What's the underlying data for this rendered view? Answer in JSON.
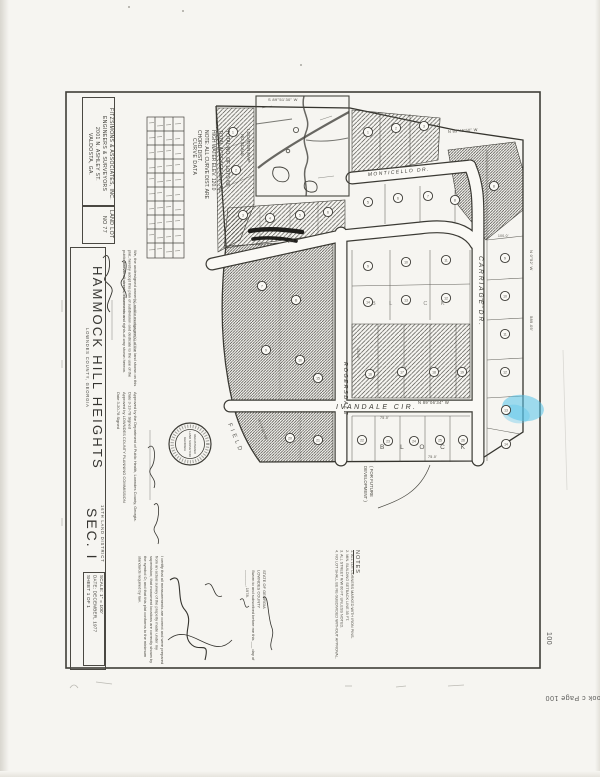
{
  "page": {
    "stamp_bottom": "look c Page 100",
    "stamp_side": "100",
    "highlight_color": "#53c3ea"
  },
  "title_block": {
    "firm_lines": [
      "FITZSIMONS & ASSOCIATES, INC.",
      "ENGINEERS & SURVEYORS",
      "2001 N. ASHLEY ST.",
      "VALDOSTA, GA."
    ],
    "land_lot": "LAND LOT NO 77",
    "title": "HAMMOCK HILL HEIGHTS",
    "county": "LOWNDES COUNTY, GEORGIA",
    "district": "16TH LAND DISTRICT",
    "section": "SEC. I",
    "scale": "SCALE: 1\" = 100'",
    "date": "DATE: DECEMBER, 1977",
    "sheet": "SHEET 1 OF 1"
  },
  "approvals": {
    "owner_cert": "We, the undersigned owner(s) and/or mortgagee(s) of the land shown on this plat, hereby adopt this plan of subdivision and dedicate to the use of the public forever all streets, easements and rights-of-way shown hereon.",
    "health": "Approved by the Department of Public Health, Lowndes County, Georgia.",
    "health_date": "Date  3-13-78      Signed",
    "planning": "Approved by  LOWNDES COUNTY  PLANNING COMMISSION",
    "planning_date": "Date  3-20-78      Signed",
    "surveyor_cert": "I certify that all measurements are correct and were prepared from an actual survey of the property made under my supervision; that monument locations are correctly shown by the symbol O; and that this plat conforms to the minimum standards required by law.",
    "notary_state": "STATE OF GEORGIA",
    "notary_county": "LOWNDES COUNTY",
    "notary_line": "Sworn to and subscribed before me this ___ day of _______, 1978.",
    "notes_heading": "NOTES",
    "notes_items": [
      "1. ALL LOT CORNERS MARKED WITH IRON PINS.",
      "2. MIN. BUILDING SETBACK LINE 35 FT.",
      "3. ALL STREET R/W 60 FT. UNLESS NOTED.",
      "4. NO LOT SHALL BE RE-SUBDIVIDED WITHOUT APPROVAL."
    ]
  },
  "map": {
    "location_map_label": "LOCATION MAP",
    "no_scale_label": "NO SCALE",
    "curve_table_title": "CURVE DATA",
    "totals_lines": [
      "TOTAL NO. OF LOTS  63",
      "TOTAL ACREAGE  19± AC.",
      "HIGH WATER ELEV. 120.0",
      "NOTE: ALL CURVE DIST. ARE",
      "CHORD DIST."
    ],
    "streets": {
      "ivandale": "IVANDALE  CIR.",
      "carriage": "CARRIAGE  DR.",
      "rogersdale": "ROGERSDALE",
      "monticello": "MONTICELLO  DR."
    },
    "block_letters_1": "B  L  O  C  K",
    "block_letters_2": "B  L  O  C  K",
    "field_label": "FIELD",
    "future_dev_line1": "( FOR FUTURE",
    "future_dev_line2": "DEVELOPMENT )",
    "seal": {
      "line1": "REGISTERED",
      "line2": "LAND SURVEYOR",
      "line3": "GEORGIA"
    },
    "lot_markers": [
      {
        "n": "1",
        "x": 233,
        "y": 132
      },
      {
        "n": "2",
        "x": 236,
        "y": 170
      },
      {
        "n": "3",
        "x": 243,
        "y": 215
      },
      {
        "n": "4",
        "x": 270,
        "y": 218
      },
      {
        "n": "5",
        "x": 300,
        "y": 215
      },
      {
        "n": "6",
        "x": 328,
        "y": 212
      },
      {
        "n": "1",
        "x": 368,
        "y": 132
      },
      {
        "n": "2",
        "x": 396,
        "y": 128
      },
      {
        "n": "3",
        "x": 424,
        "y": 126
      },
      {
        "n": "5",
        "x": 368,
        "y": 202
      },
      {
        "n": "6",
        "x": 398,
        "y": 198
      },
      {
        "n": "7",
        "x": 428,
        "y": 196
      },
      {
        "n": "8",
        "x": 455,
        "y": 200
      },
      {
        "n": "9",
        "x": 368,
        "y": 266
      },
      {
        "n": "10",
        "x": 406,
        "y": 262
      },
      {
        "n": "11",
        "x": 446,
        "y": 260
      },
      {
        "n": "14",
        "x": 368,
        "y": 302
      },
      {
        "n": "13",
        "x": 406,
        "y": 300
      },
      {
        "n": "12",
        "x": 446,
        "y": 298
      },
      {
        "n": "15",
        "x": 318,
        "y": 378
      },
      {
        "n": "16",
        "x": 370,
        "y": 374
      },
      {
        "n": "17",
        "x": 402,
        "y": 372
      },
      {
        "n": "18",
        "x": 434,
        "y": 372
      },
      {
        "n": "19",
        "x": 462,
        "y": 372
      },
      {
        "n": "20",
        "x": 290,
        "y": 438
      },
      {
        "n": "21",
        "x": 318,
        "y": 440
      },
      {
        "n": "22",
        "x": 362,
        "y": 440
      },
      {
        "n": "23",
        "x": 388,
        "y": 441
      },
      {
        "n": "24",
        "x": 414,
        "y": 441
      },
      {
        "n": "25",
        "x": 440,
        "y": 440
      },
      {
        "n": "26",
        "x": 463,
        "y": 440
      },
      {
        "n": "9",
        "x": 505,
        "y": 258
      },
      {
        "n": "10",
        "x": 505,
        "y": 296
      },
      {
        "n": "11",
        "x": 505,
        "y": 334
      },
      {
        "n": "12",
        "x": 505,
        "y": 372
      },
      {
        "n": "13",
        "x": 506,
        "y": 410
      },
      {
        "n": "14",
        "x": 506,
        "y": 444
      },
      {
        "n": "7",
        "x": 262,
        "y": 286
      },
      {
        "n": "8",
        "x": 296,
        "y": 300
      },
      {
        "n": "9",
        "x": 266,
        "y": 350
      },
      {
        "n": "10",
        "x": 300,
        "y": 360
      },
      {
        "n": "8",
        "x": 494,
        "y": 186
      }
    ],
    "dims": [
      {
        "t": "S 89°51'30\" W",
        "x": 268,
        "y": 101,
        "r": 0,
        "s": 4
      },
      {
        "t": "N 89°45'50\" W",
        "x": 448,
        "y": 133,
        "r": -4,
        "s": 4
      },
      {
        "t": "N 0°52' W",
        "x": 530,
        "y": 250,
        "r": 90,
        "s": 4
      },
      {
        "t": "589.05'",
        "x": 530,
        "y": 316,
        "r": 90,
        "s": 4
      },
      {
        "t": "N 89°06'34\" W",
        "x": 418,
        "y": 404,
        "r": 0,
        "s": 4.2
      },
      {
        "t": "140.0'",
        "x": 357,
        "y": 348,
        "r": 90,
        "s": 3.6
      },
      {
        "t": "75.0'",
        "x": 380,
        "y": 419,
        "r": 0,
        "s": 3.6
      },
      {
        "t": "75.0'",
        "x": 428,
        "y": 458,
        "r": 0,
        "s": 3.6
      },
      {
        "t": "150.0'",
        "x": 482,
        "y": 298,
        "r": 90,
        "s": 3.6
      },
      {
        "t": "208.7'",
        "x": 288,
        "y": 243,
        "r": -12,
        "s": 3.6
      },
      {
        "t": "100.0'",
        "x": 498,
        "y": 237,
        "r": 0,
        "s": 3.3
      },
      {
        "t": "R=14  90°56'",
        "x": 258,
        "y": 420,
        "r": 70,
        "s": 3.4
      }
    ]
  }
}
